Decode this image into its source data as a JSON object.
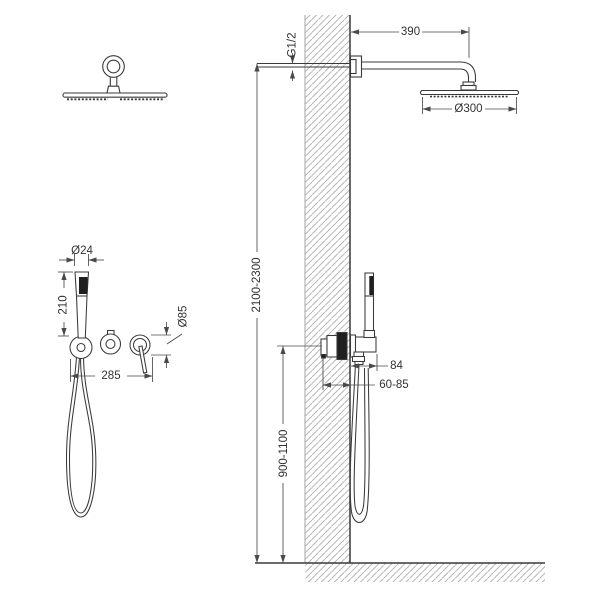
{
  "diagram": {
    "kind": "shower-system-installation-drawing",
    "colors": {
      "line": "#3a3a3a",
      "dimension_line": "#4a4a4a",
      "hatch": "#ababab",
      "dark_fill": "#1f1f1f",
      "background": "#ffffff"
    },
    "labels": {
      "arm_length": "390",
      "thread": "G1/2",
      "head_diameter": "Ø300",
      "overall_height": "2100-2300",
      "holder_projection": "84",
      "valve_depth": "60-85",
      "mixer_height": "900-1100",
      "handshower_diameter": "Ø24",
      "handshower_length": "210",
      "trim_diameter": "Ø85",
      "trim_spacing": "285"
    }
  }
}
